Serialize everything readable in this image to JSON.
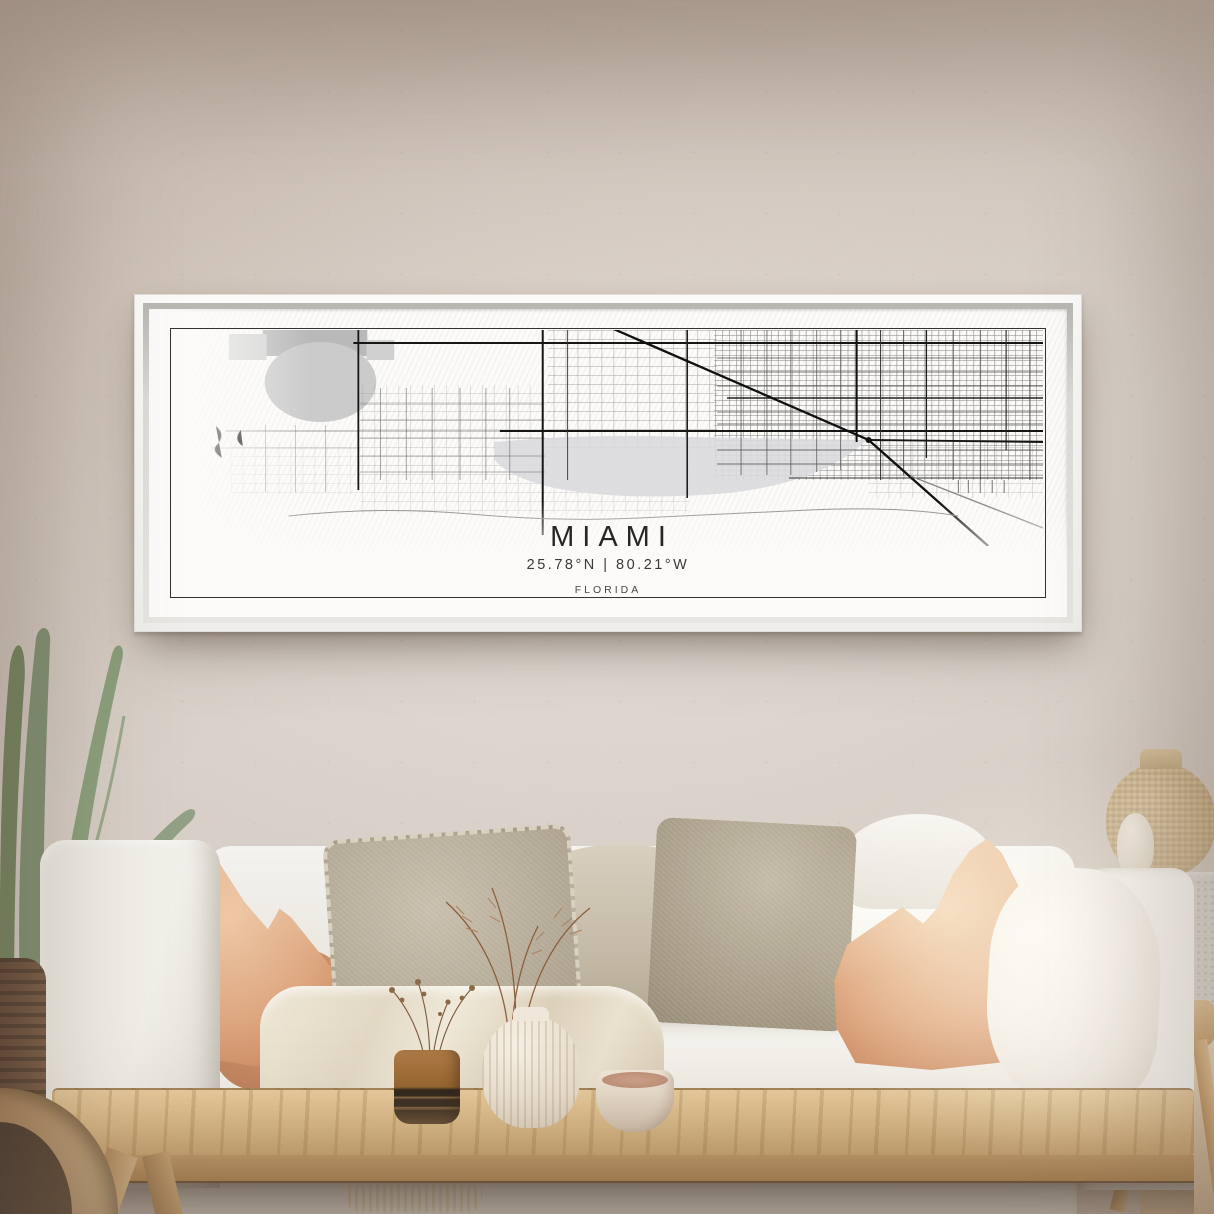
{
  "artwork": {
    "title": "MIAMI",
    "coordinates": "25.78°N | 80.21°W",
    "state_label": "FLORIDA"
  },
  "palette": {
    "wall": "#d3c8be",
    "frame": "#f6f5f3",
    "canvas": "#fcfbf9",
    "map_ink": "#1c1c1c",
    "map_water_gray": "#dadade",
    "terracotta_pillow": "#d89d78",
    "oat_pillow": "#aa9f8b",
    "sofa_fabric": "#efece6",
    "table_wood": "#ddbc88",
    "plant_green": "#8a9b7e"
  }
}
